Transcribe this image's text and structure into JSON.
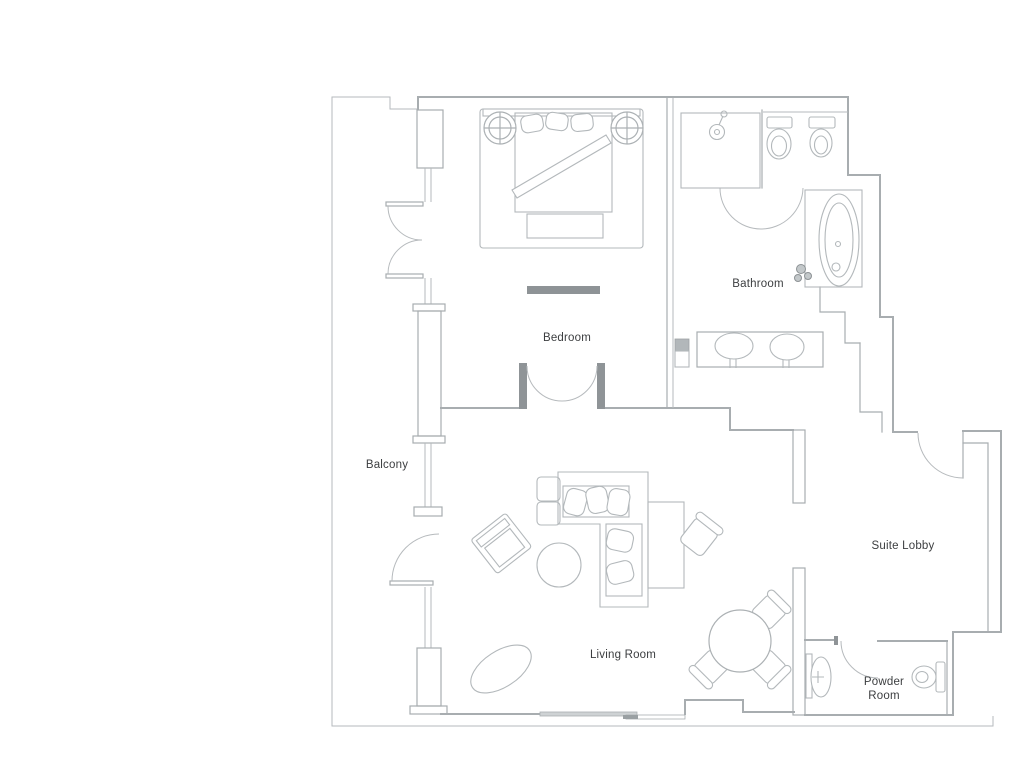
{
  "document": {
    "type": "hotel-suite-floor-plan",
    "background": "#ffffff"
  },
  "rooms": {
    "balcony": {
      "label": "Balcony"
    },
    "bedroom": {
      "label": "Bedroom"
    },
    "bathroom": {
      "label": "Bathroom"
    },
    "living_room": {
      "label": "Living Room"
    },
    "suite_lobby": {
      "label": "Suite Lobby"
    },
    "powder_room": {
      "label_line1": "Powder",
      "label_line2": "Room"
    }
  },
  "colors": {
    "wall_line": "#a8adb0",
    "light_line": "#b6babd",
    "furniture_line": "#b3b8bb",
    "label_text": "#3c3e40",
    "tv_console": "#8e9396",
    "door_jamb": "#8f9497",
    "sliding_door": "#9aa0a3",
    "background": "#ffffff"
  },
  "fixtures": {
    "bedroom": [
      "double-bed",
      "pillows",
      "bed-runner",
      "nightstand-left",
      "nightstand-right",
      "foot-bench",
      "tv-console"
    ],
    "bathroom": [
      "shower-stall",
      "shower-head",
      "toilet",
      "bidet",
      "bathtub",
      "double-sink-vanity",
      "plant",
      "structural-column"
    ],
    "living_room": [
      "l-shaped-sofa",
      "sofa-pillows",
      "ottomans",
      "coffee-table",
      "armchair",
      "area-rug",
      "desk",
      "desk-chair",
      "round-dining-table",
      "dining-chairs"
    ],
    "powder_room": [
      "pedestal-sink",
      "toilet"
    ],
    "doors": [
      "balcony-double-door-upper",
      "balcony-door-lower",
      "bedroom-french-doors",
      "shower-door",
      "wc-door",
      "suite-entry-door",
      "powder-room-door",
      "living-room-sliding-door"
    ]
  }
}
